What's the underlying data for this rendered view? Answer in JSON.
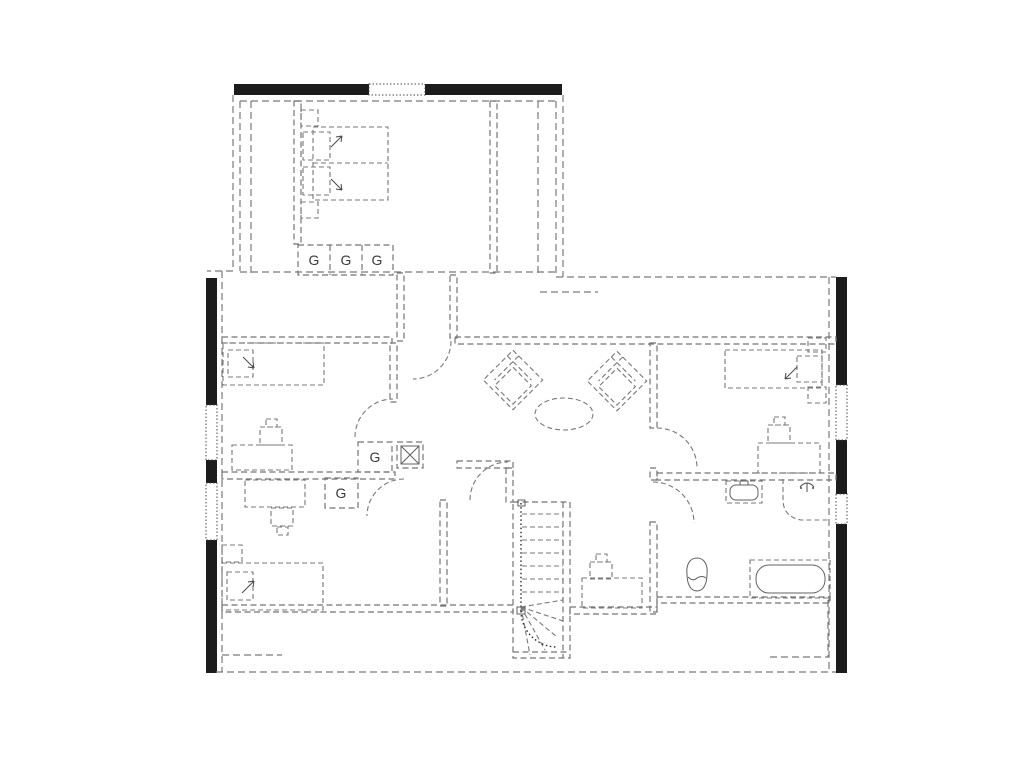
{
  "plan": {
    "type": "architectural-floor-plan",
    "floor": "attic-storey",
    "labels": {
      "wardrobe_top_left": "G",
      "wardrobe_top_middle": "G",
      "wardrobe_top_right": "G",
      "wardrobe_hall": "G",
      "wardrobe_room3": "G"
    },
    "colors": {
      "wall": "#1c1c1c",
      "dashed_line": "#777777",
      "label_text": "#3a3a3a",
      "background": "#ffffff"
    },
    "fixtures": [
      "double-bed",
      "single-bed-left",
      "single-bed-bottom",
      "single-bed-right",
      "wardrobe-row",
      "wardrobe-hall",
      "wardrobe-room3",
      "desk-room2",
      "desk-room3",
      "desk-room4",
      "desk-stair-room",
      "armchair-left",
      "armchair-right",
      "oval-table",
      "staircase-with-winders",
      "ventilation-shaft",
      "washbasin",
      "shower",
      "toilet",
      "bathtub"
    ]
  }
}
